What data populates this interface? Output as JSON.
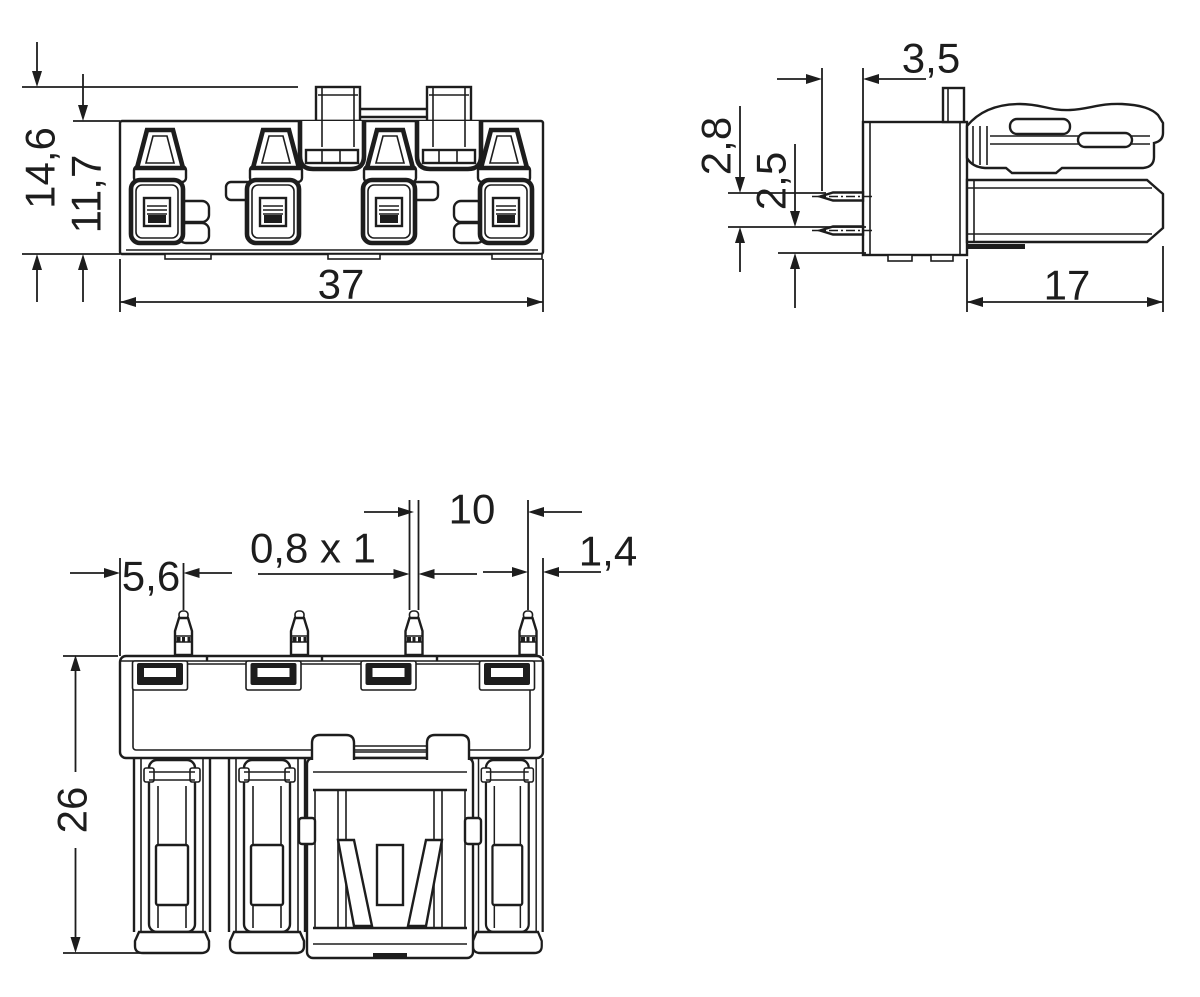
{
  "page": {
    "background": "#ffffff",
    "line_color": "#1d1d1d",
    "description": "Dimensional technical drawing of a 4-pole PCB socket connector, three orthographic views"
  },
  "views": {
    "front": {
      "dims": {
        "height_overall": "14,6",
        "height_body": "11,7",
        "width": "37"
      }
    },
    "side": {
      "dims": {
        "pin_protrusion": "3,5",
        "pin_vertical_offset": "2,8",
        "pin_bottom_offset": "2,5",
        "depth": "17"
      }
    },
    "top": {
      "dims": {
        "edge_to_first_pin": "5,6",
        "pin_cross_section": "0,8 x 1",
        "pin_pitch": "10",
        "last_pin_to_edge": "1,4",
        "overall_height": "26"
      }
    }
  }
}
